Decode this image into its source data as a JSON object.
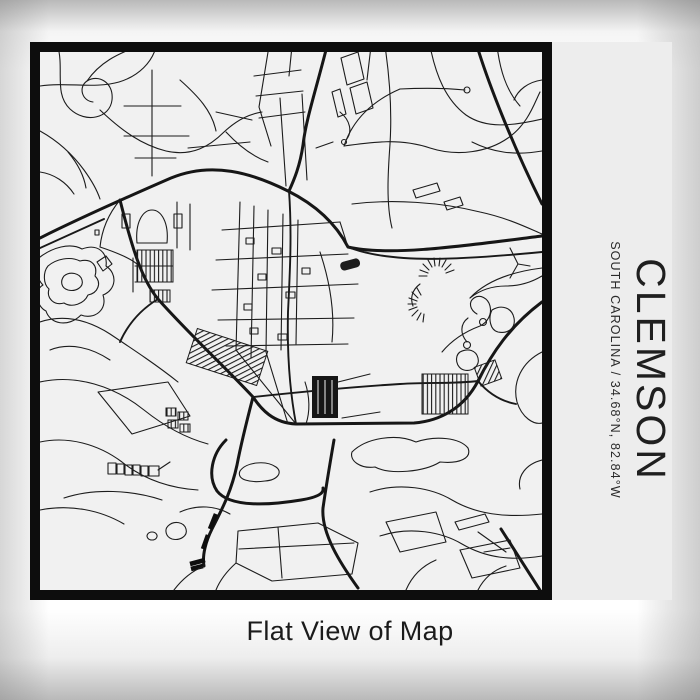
{
  "print": {
    "title": "CLEMSON",
    "subtitle": "SOUTH CAROLINA / 34.68°N, 82.84°W",
    "caption": "Flat View of Map"
  },
  "map": {
    "place": "Clemson",
    "region": "South Carolina",
    "latitude": "34.68°N",
    "longitude": "82.84°W"
  },
  "colors": {
    "ink": "#1c1c1c",
    "map_paper": "#f1f1f1",
    "print_paper": "#ededed",
    "frame": "#0d0d0d",
    "backdrop_center": "#ffffff",
    "backdrop_edge": "#b9b9b9"
  }
}
